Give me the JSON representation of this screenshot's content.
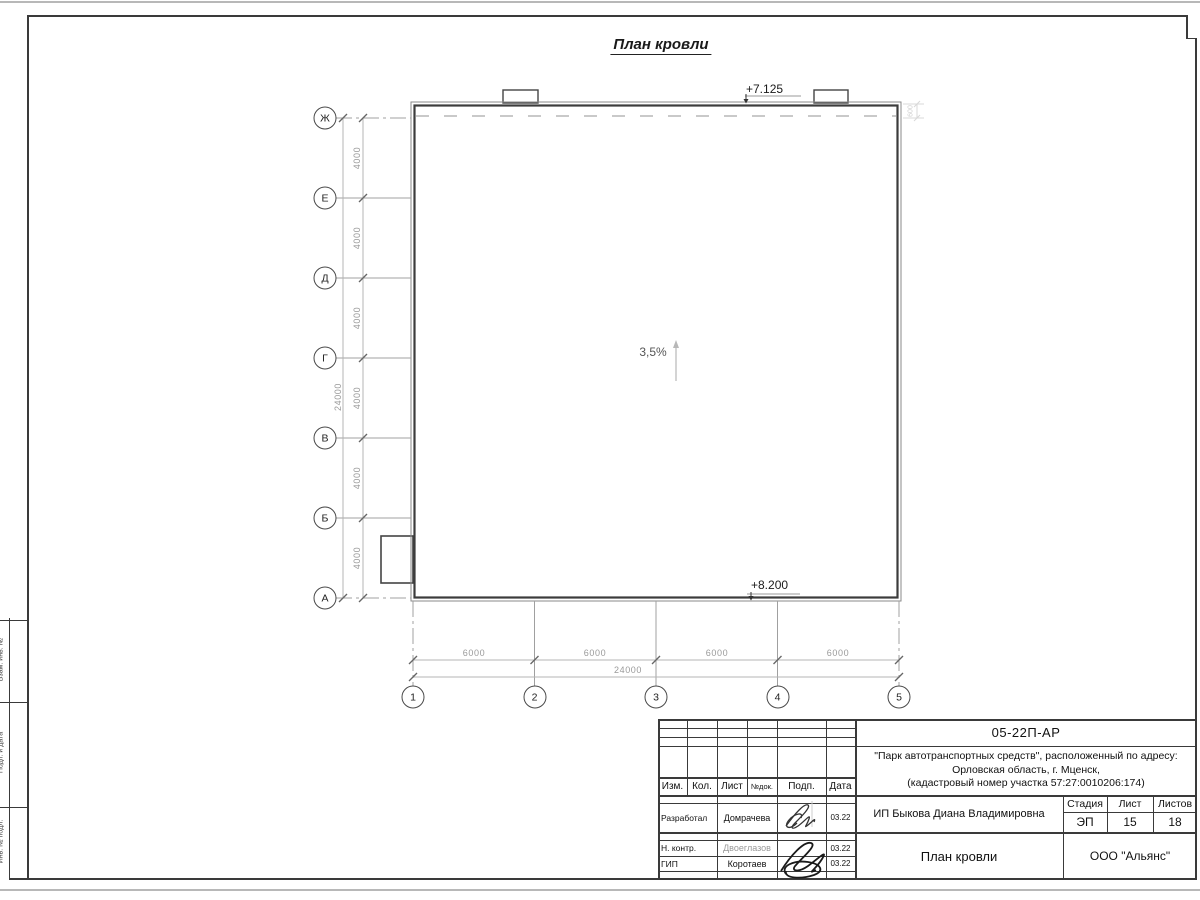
{
  "drawing": {
    "title": "План кровли",
    "slope": "3,5%",
    "elevation_top": "+7.125",
    "elevation_bottom": "+8.200",
    "parapet_dim": "600"
  },
  "axes": {
    "letters": [
      "Ж",
      "Е",
      "Д",
      "Г",
      "В",
      "Б",
      "А"
    ],
    "numbers": [
      "1",
      "2",
      "3",
      "4",
      "5"
    ]
  },
  "dimensions": {
    "left_segments": [
      "4000",
      "4000",
      "4000",
      "4000",
      "4000",
      "4000"
    ],
    "left_total": "24000",
    "bottom_segments": [
      "6000",
      "6000",
      "6000",
      "6000"
    ],
    "bottom_total": "24000"
  },
  "title_block": {
    "doc_number": "05-22П-АР",
    "project_line1": "\"Парк автотранспортных средств\",  расположенный по адресу:",
    "project_line2": "Орловская область, г. Мценск,",
    "project_line3": "(кадастровый номер участка 57:27:0010206:174)",
    "client": "ИП Быкова Диана Владимировна",
    "sheet_name": "План кровли",
    "company": "ООО \"Альянс\"",
    "col_headers": {
      "izm": "Изм.",
      "kol": "Кол.",
      "list": "Лист",
      "doc": "№док.",
      "podp": "Подп.",
      "date": "Дата"
    },
    "stage_header": "Стадия",
    "list_header": "Лист",
    "listov_header": "Листов",
    "stage": "ЭП",
    "sheet_no": "15",
    "sheets_total": "18",
    "roles": [
      {
        "role": "Разработал",
        "name": "Домрачева",
        "date": "03.22"
      },
      {
        "role": "Н. контр.",
        "name": "Двоеглазов",
        "date": "03.22"
      },
      {
        "role": "ГИП",
        "name": "Коротаев",
        "date": "03.22"
      }
    ]
  },
  "left_margin": {
    "labels": [
      "Взам. инв. №",
      "Подп. и дата",
      "Инв. № подл."
    ]
  }
}
